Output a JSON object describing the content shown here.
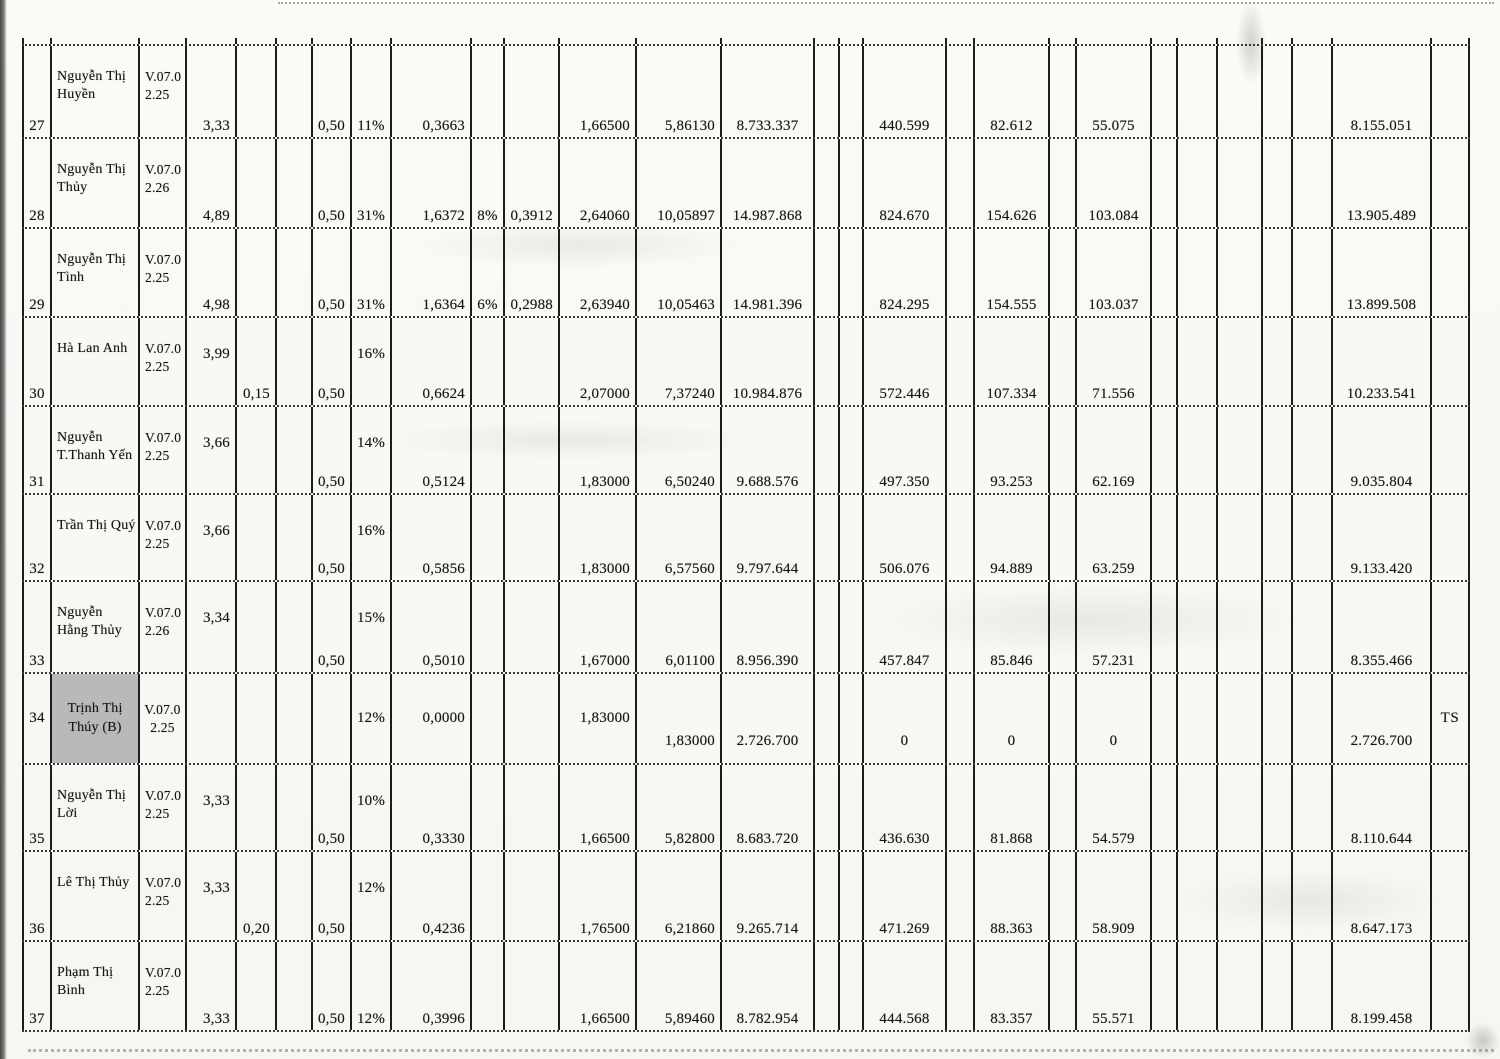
{
  "colors": {
    "highlight_gray": "#b9b9b9",
    "ink": "#1a1a1a",
    "grid_line": "#1c1c1c",
    "paper": "#faf9f6"
  },
  "table": {
    "rows": [
      {
        "style": "A",
        "num": "27",
        "name": "Nguyễn Thị\nHuyền",
        "code": "V.07.0\n2.25",
        "coef": "3,33",
        "extra": "",
        "half": "0,50",
        "pct1": "11%",
        "v1": "0,3663",
        "pct2": "",
        "v2": "",
        "v3": "1,66500",
        "v4": "5,86130",
        "v5": "8.733.337",
        "v6": "440.599",
        "v7": "82.612",
        "v8": "55.075",
        "total": "8.155.051",
        "ts": ""
      },
      {
        "style": "A",
        "num": "28",
        "name": "Nguyễn Thị\nThủy",
        "code": "V.07.0\n2.26",
        "coef": "4,89",
        "extra": "",
        "half": "0,50",
        "pct1": "31%",
        "v1": "1,6372",
        "pct2": "8%",
        "v2": "0,3912",
        "v3": "2,64060",
        "v4": "10,05897",
        "v5": "14.987.868",
        "v6": "824.670",
        "v7": "154.626",
        "v8": "103.084",
        "total": "13.905.489",
        "ts": ""
      },
      {
        "style": "A",
        "num": "29",
        "name": "Nguyễn Thị\nTình",
        "code": "V.07.0\n2.25",
        "coef": "4,98",
        "extra": "",
        "half": "0,50",
        "pct1": "31%",
        "v1": "1,6364",
        "pct2": "6%",
        "v2": "0,2988",
        "v3": "2,63940",
        "v4": "10,05463",
        "v5": "14.981.396",
        "v6": "824.295",
        "v7": "154.555",
        "v8": "103.037",
        "total": "13.899.508",
        "ts": ""
      },
      {
        "style": "B",
        "num": "30",
        "name": "Hà Lan Anh",
        "code": "V.07.0\n2.25",
        "coef": "3,99",
        "extra": "0,15",
        "half": "0,50",
        "pct1": "16%",
        "v1": "0,6624",
        "pct2": "",
        "v2": "",
        "v3": "2,07000",
        "v4": "7,37240",
        "v5": "10.984.876",
        "v6": "572.446",
        "v7": "107.334",
        "v8": "71.556",
        "total": "10.233.541",
        "ts": ""
      },
      {
        "style": "B",
        "num": "31",
        "name": "Nguyễn\nT.Thanh Yến",
        "code": "V.07.0\n2.25",
        "coef": "3,66",
        "extra": "",
        "half": "0,50",
        "pct1": "14%",
        "v1": "0,5124",
        "pct2": "",
        "v2": "",
        "v3": "1,83000",
        "v4": "6,50240",
        "v5": "9.688.576",
        "v6": "497.350",
        "v7": "93.253",
        "v8": "62.169",
        "total": "9.035.804",
        "ts": ""
      },
      {
        "style": "B",
        "num": "32",
        "name": "Trần Thị Quý",
        "code": "V.07.0\n2.25",
        "coef": "3,66",
        "extra": "",
        "half": "0,50",
        "pct1": "16%",
        "v1": "0,5856",
        "pct2": "",
        "v2": "",
        "v3": "1,83000",
        "v4": "6,57560",
        "v5": "9.797.644",
        "v6": "506.076",
        "v7": "94.889",
        "v8": "63.259",
        "total": "9.133.420",
        "ts": ""
      },
      {
        "style": "B",
        "num": "33",
        "name": "Nguyễn\nHằng Thủy",
        "code": "V.07.0\n2.26",
        "coef": "3,34",
        "extra": "",
        "half": "0,50",
        "pct1": "15%",
        "v1": "0,5010",
        "pct2": "",
        "v2": "",
        "v3": "1,67000",
        "v4": "6,01100",
        "v5": "8.956.390",
        "v6": "457.847",
        "v7": "85.846",
        "v8": "57.231",
        "total": "8.355.466",
        "ts": ""
      },
      {
        "style": "C",
        "num": "34",
        "name": "Trịnh Thị\nThúy (B)",
        "code": "V.07.0\n2.25",
        "coef": "",
        "extra": "",
        "half": "",
        "pct1": "12%",
        "v1": "0,0000",
        "pct2": "",
        "v2": "",
        "v3": "1,83000",
        "v4": "1,83000",
        "v5": "2.726.700",
        "v6": "0",
        "v7": "0",
        "v8": "0",
        "total": "2.726.700",
        "ts": "TS",
        "highlight": true
      },
      {
        "style": "B",
        "num": "35",
        "name": "Nguyễn Thị\nLời",
        "code": "V.07.0\n2.25",
        "coef": "3,33",
        "extra": "",
        "half": "0,50",
        "pct1": "10%",
        "v1": "0,3330",
        "pct2": "",
        "v2": "",
        "v3": "1,66500",
        "v4": "5,82800",
        "v5": "8.683.720",
        "v6": "436.630",
        "v7": "81.868",
        "v8": "54.579",
        "total": "8.110.644",
        "ts": ""
      },
      {
        "style": "B",
        "num": "36",
        "name": "Lê Thị Thủy",
        "code": "V.07.0\n2.25",
        "coef": "3,33",
        "extra": "0,20",
        "half": "0,50",
        "pct1": "12%",
        "v1": "0,4236",
        "pct2": "",
        "v2": "",
        "v3": "1,76500",
        "v4": "6,21860",
        "v5": "9.265.714",
        "v6": "471.269",
        "v7": "88.363",
        "v8": "58.909",
        "total": "8.647.173",
        "ts": ""
      },
      {
        "style": "A",
        "num": "37",
        "name": "Phạm Thị\nBình",
        "code": "V.07.0\n2.25",
        "coef": "3,33",
        "extra": "",
        "half": "0,50",
        "pct1": "12%",
        "v1": "0,3996",
        "pct2": "",
        "v2": "",
        "v3": "1,66500",
        "v4": "5,89460",
        "v5": "8.782.954",
        "v6": "444.568",
        "v7": "83.357",
        "v8": "55.571",
        "total": "8.199.458",
        "ts": ""
      }
    ]
  }
}
